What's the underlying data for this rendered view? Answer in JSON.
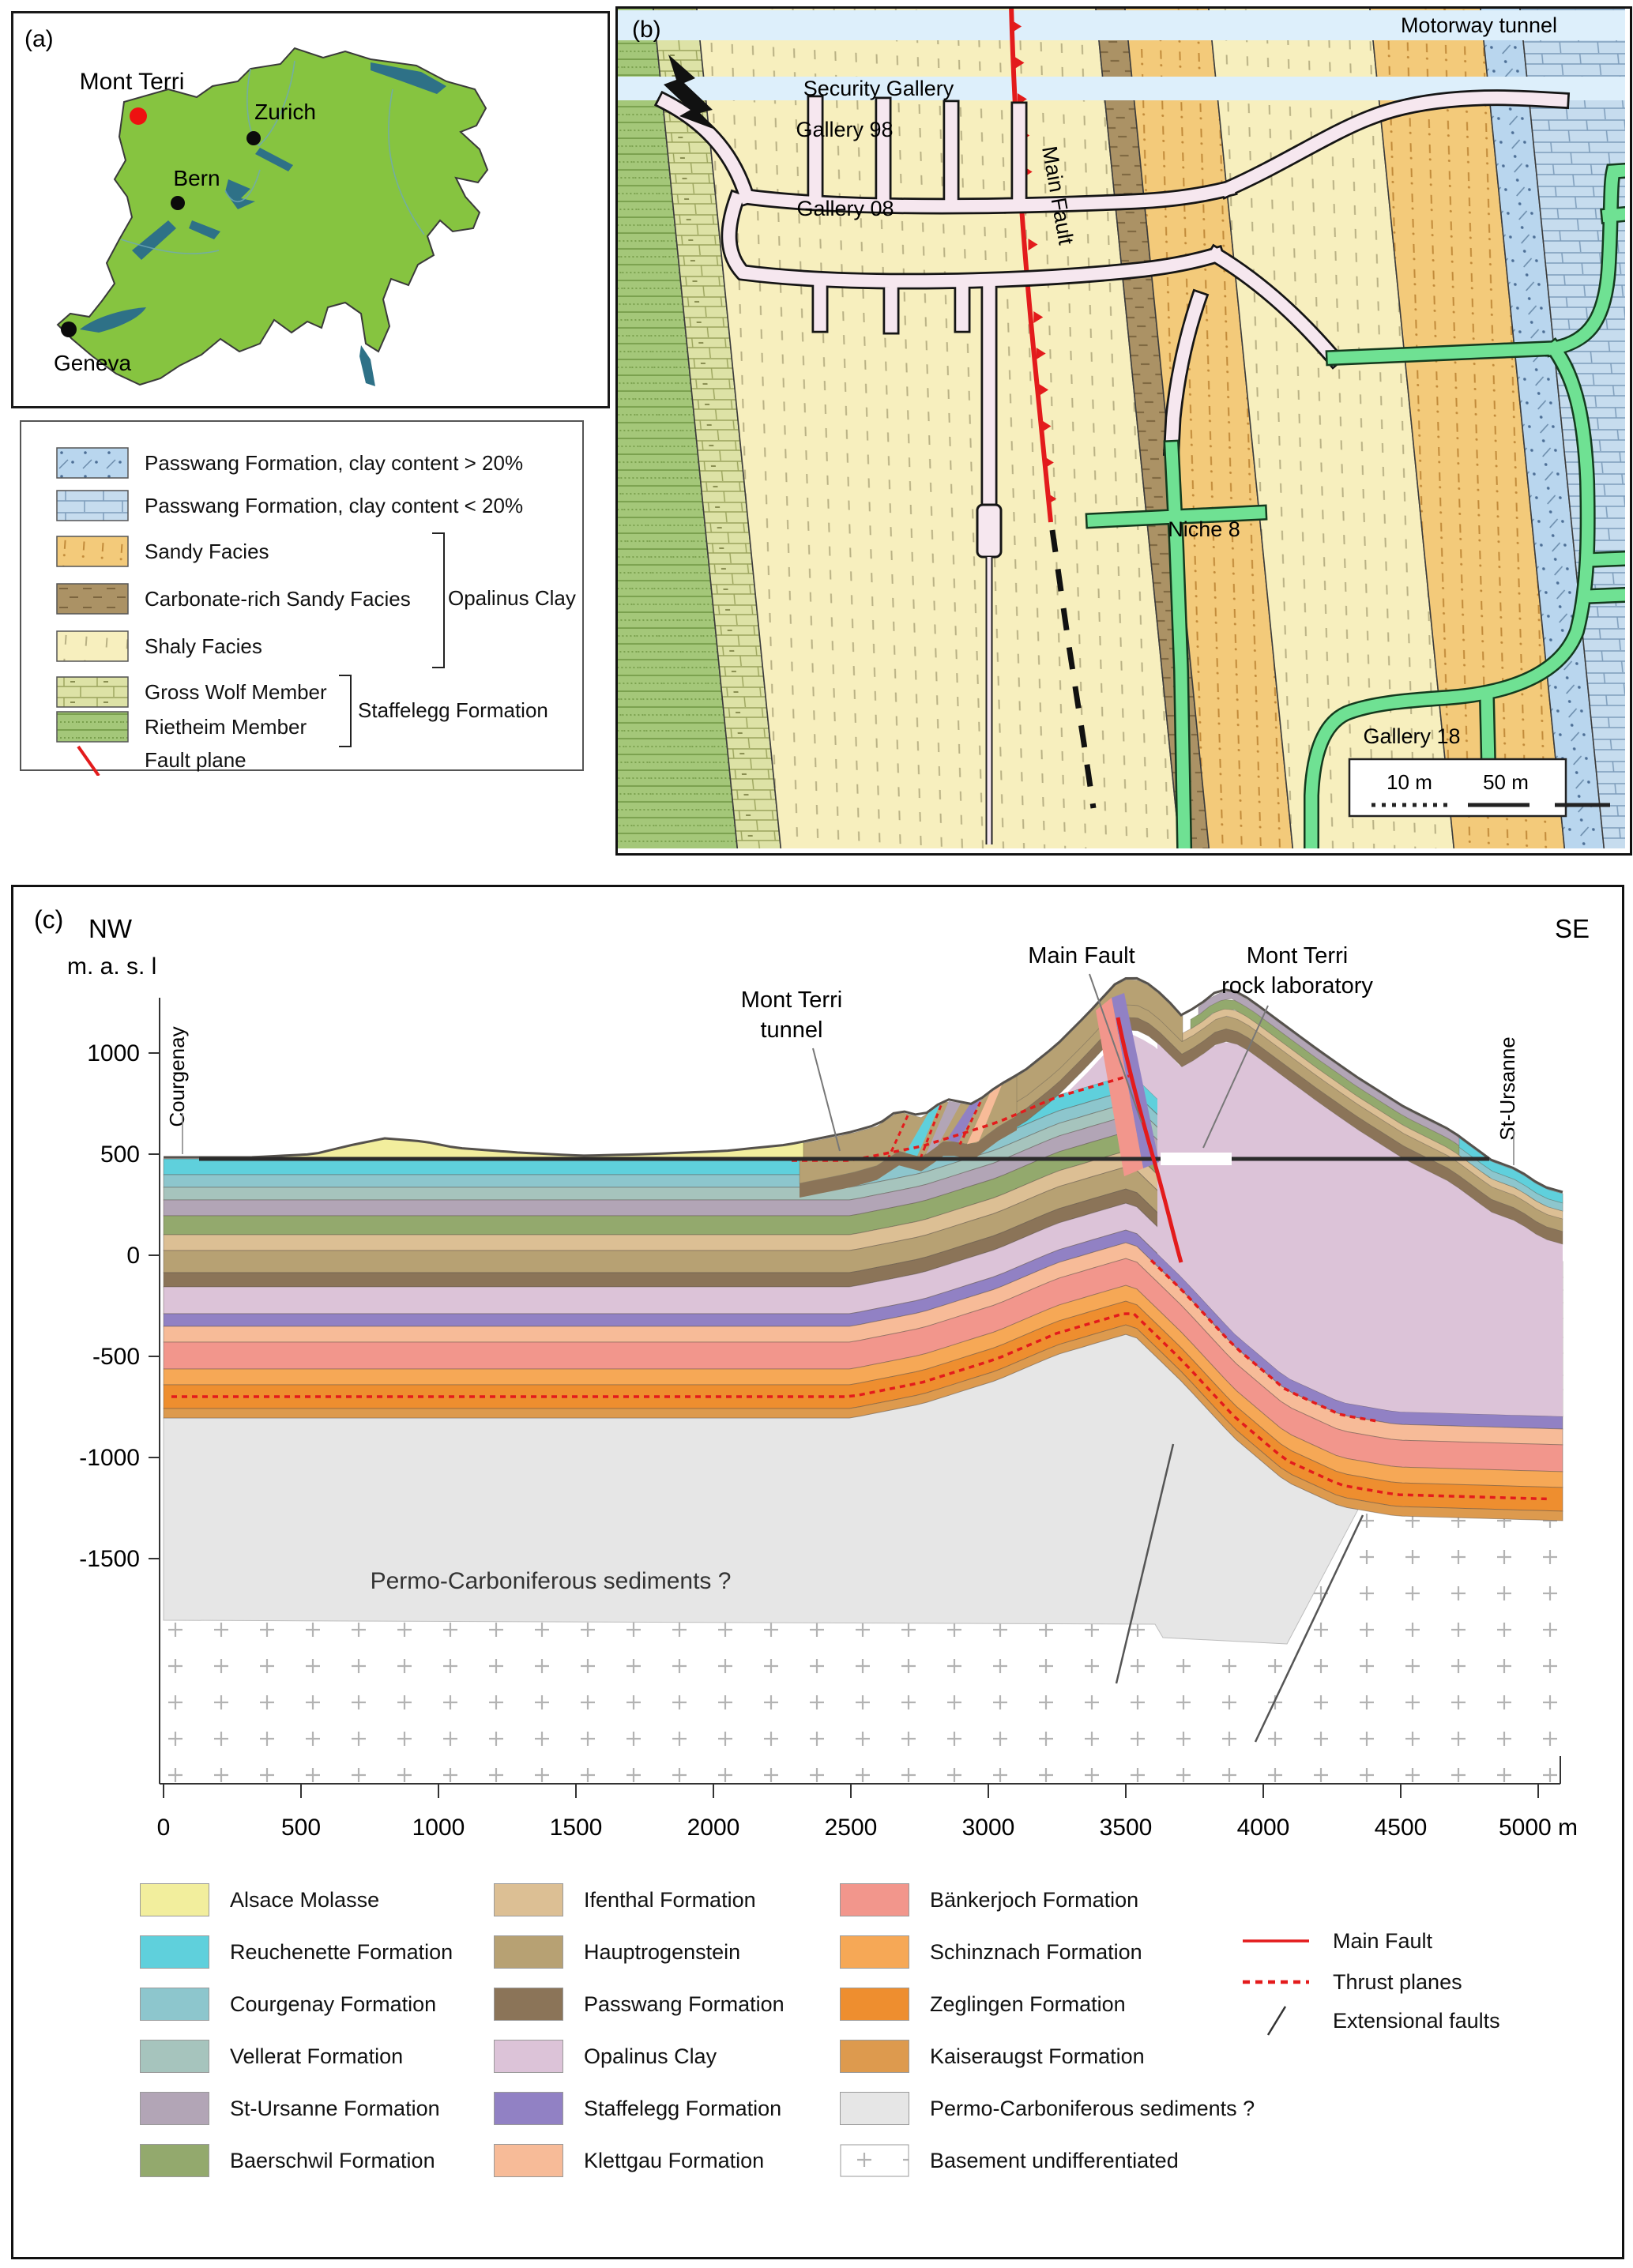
{
  "figure": {
    "panel_a_tag": "(a)",
    "panel_b_tag": "(b)",
    "panel_c_tag": "(c)"
  },
  "panel_a": {
    "cities": [
      {
        "name": "Mont Terri",
        "marker": "red-dot"
      },
      {
        "name": "Zurich",
        "marker": "black-dot"
      },
      {
        "name": "Bern",
        "marker": "black-dot"
      },
      {
        "name": "Geneva",
        "marker": "black-dot"
      }
    ],
    "colors": {
      "land": "#86c440",
      "water": "#2e7187",
      "site_dot": "#ee1111",
      "city_dot": "#0b0b0b"
    }
  },
  "legend_b": {
    "items": [
      {
        "label": "Passwang Formation, clay content > 20%",
        "swatch": "pat-bdot"
      },
      {
        "label": "Passwang Formation, clay content < 20%",
        "swatch": "pat-bbrick"
      },
      {
        "label": "Sandy Facies",
        "swatch": "pat-sandy"
      },
      {
        "label": "Carbonate-rich Sandy Facies",
        "swatch": "pat-carb"
      },
      {
        "label": "Shaly Facies",
        "swatch": "pat-shaly"
      },
      {
        "label": "Gross Wolf Member",
        "swatch": "pat-gw"
      },
      {
        "label": "Rietheim Member",
        "swatch": "pat-riet"
      },
      {
        "label": "Fault plane",
        "swatch": "fault-line"
      }
    ],
    "groups": {
      "opalinus": "Opalinus Clay",
      "staffelegg": "Staffelegg Formation"
    }
  },
  "panel_b": {
    "labels": {
      "motorway": "Motorway tunnel",
      "security": "Security Gallery",
      "gallery98": "Gallery 98",
      "gallery08": "Gallery 08",
      "main_fault": "Main Fault",
      "niche8": "Niche 8",
      "gallery18": "Gallery 18"
    },
    "scale": {
      "s10": "10 m",
      "s50": "50 m"
    },
    "colors": {
      "shaly": "#f7efbe",
      "sandy": "#f3ca7a",
      "carbonate": "#ab9265",
      "grosswolf": "#dde2a6",
      "rietheim": "#a4c779",
      "passwang_dotted": "#b9d6ee",
      "passwang_brick": "#c6dcee",
      "gallery_pink": "#f6e7ef",
      "gallery_green": "#6fe193",
      "tunnel_band": "#ddeffb",
      "fault": "#e31b1c"
    }
  },
  "panel_c": {
    "compass_nw": "NW",
    "compass_se": "SE",
    "axis_label": "m. a. s. l",
    "towns": {
      "left": "Courgenay",
      "right": "St-Ursanne"
    },
    "annotations": {
      "tunnel_1": "Mont Terri",
      "tunnel_2": "tunnel",
      "main_fault": "Main Fault",
      "lab_1": "Mont Terri",
      "lab_2": "rock laboratory",
      "permo": "Permo-Carboniferous sediments ?"
    },
    "y_ticks": [
      "1000",
      "500",
      "0",
      "-500",
      "-1000",
      "-1500"
    ],
    "x_ticks": [
      "0",
      "500",
      "1000",
      "1500",
      "2000",
      "2500",
      "3000",
      "3500",
      "4000",
      "4500",
      "5000 m"
    ],
    "colors": {
      "alsace": "#f2ee9d",
      "reuchenette": "#5fd0dc",
      "courgenay": "#8dc6cd",
      "vellerat": "#a6c4bd",
      "st_ursanne": "#b2a5b6",
      "baerschwil": "#93a96d",
      "ifenthal": "#dcbf94",
      "hauptrogenstein": "#b7a173",
      "passwang": "#8b7458",
      "opalinus": "#dcc3d8",
      "staffelegg": "#9181c4",
      "klettgau": "#f7bb98",
      "bankerjoch": "#f2968c",
      "schinznach": "#f6a856",
      "zeglingen": "#ee8e2f",
      "kaiseraugst": "#dd9a4e",
      "permo": "#e6e6e6",
      "fault": "#e31b1c",
      "tunnel_line": "#2b2b2b",
      "surface": "#55514c"
    }
  },
  "legend_c": {
    "col1": [
      {
        "label": "Alsace Molasse",
        "color": "#f2ee9d"
      },
      {
        "label": "Reuchenette Formation",
        "color": "#5fd0dc"
      },
      {
        "label": "Courgenay Formation",
        "color": "#8dc6cd"
      },
      {
        "label": "Vellerat Formation",
        "color": "#a6c4bd"
      },
      {
        "label": "St-Ursanne Formation",
        "color": "#b2a5b6"
      },
      {
        "label": "Baerschwil Formation",
        "color": "#93a96d"
      }
    ],
    "col2": [
      {
        "label": "Ifenthal Formation",
        "color": "#dcbf94"
      },
      {
        "label": "Hauptrogenstein",
        "color": "#b7a173"
      },
      {
        "label": "Passwang Formation",
        "color": "#8b7458"
      },
      {
        "label": "Opalinus Clay",
        "color": "#dcc3d8"
      },
      {
        "label": "Staffelegg Formation",
        "color": "#9181c4"
      },
      {
        "label": "Klettgau Formation",
        "color": "#f7bb98"
      }
    ],
    "col3": [
      {
        "label": "Bänkerjoch Formation",
        "color": "#f2968c"
      },
      {
        "label": "Schinznach Formation",
        "color": "#f6a856"
      },
      {
        "label": "Zeglingen Formation",
        "color": "#ee8e2f"
      },
      {
        "label": "Kaiseraugst Formation",
        "color": "#dd9a4e"
      },
      {
        "label": "Permo-Carboniferous sediments ?",
        "color": "#e6e6e6"
      },
      {
        "label": "Basement undifferentiated",
        "color": "basement-pattern"
      }
    ],
    "faults": [
      {
        "label": "Main Fault",
        "style": "red-solid"
      },
      {
        "label": "Thrust planes",
        "style": "red-dashed"
      },
      {
        "label": "Extensional faults",
        "style": "black-diagonal"
      }
    ]
  }
}
